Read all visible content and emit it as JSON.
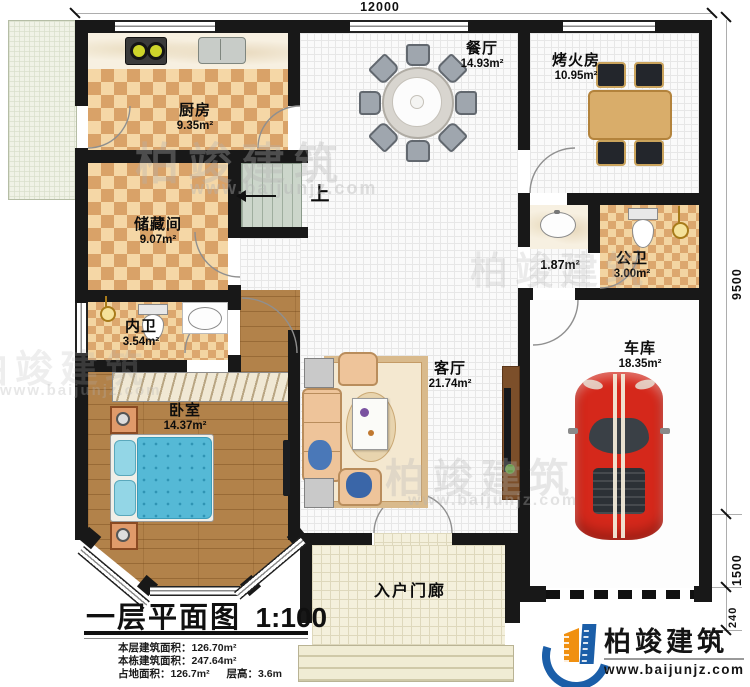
{
  "plan": {
    "dimensions": {
      "top": "12000",
      "right_upper": "9500",
      "right_lower": "1500",
      "right_bottom": "240"
    },
    "rooms": {
      "kitchen": {
        "name": "厨房",
        "area": "9.35m²"
      },
      "dining": {
        "name": "餐厅",
        "area": "14.93m²"
      },
      "fire_room": {
        "name": "烤火房",
        "area": "10.95m²"
      },
      "storage": {
        "name": "储藏间",
        "area": "9.07m²"
      },
      "wash_alcove": {
        "area": "1.87m²"
      },
      "public_bath": {
        "name": "公卫",
        "area": "3.00m²"
      },
      "private_bath": {
        "name": "内卫",
        "area": "3.54m²"
      },
      "bedroom": {
        "name": "卧室",
        "area": "14.37m²"
      },
      "living": {
        "name": "客厅",
        "area": "21.74m²"
      },
      "garage": {
        "name": "车库",
        "area": "18.35m²"
      },
      "porch": {
        "name": "入户门廊"
      },
      "stairs": {
        "up": "上"
      }
    }
  },
  "title_block": {
    "title": "一层平面图",
    "scale": "1:100",
    "items": [
      {
        "label": "本层建筑面积：",
        "value": "126.70m²"
      },
      {
        "label": "本栋建筑面积：",
        "value": "247.64m²"
      },
      {
        "label": "占地面积：",
        "value": "126.7m²"
      },
      {
        "label": "层高：",
        "value": "3.6m"
      }
    ]
  },
  "brand": {
    "name": "柏竣建筑",
    "url": "www.baijunjz.com"
  },
  "colors": {
    "wall": "#181818",
    "car_red": "#d5281b",
    "logo_blue": "#1b5ea8",
    "logo_orange": "#f09010",
    "bed_blue": "#55b9d6",
    "checker_dark": "#d9a268",
    "checker_light": "#f5d7a6"
  }
}
